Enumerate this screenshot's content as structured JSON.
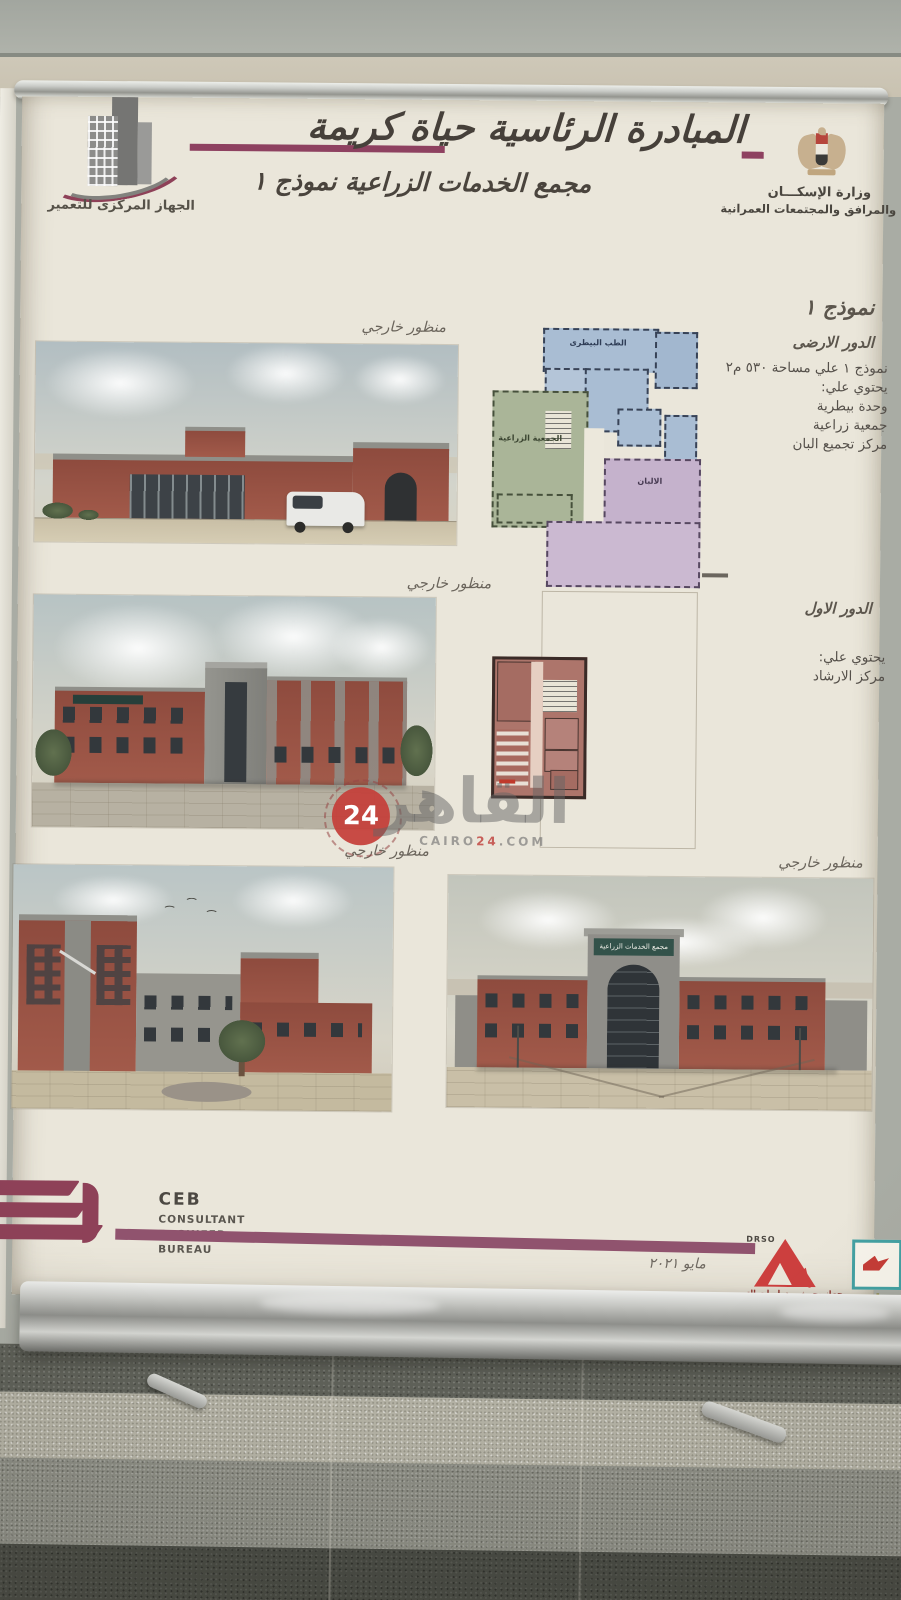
{
  "banner": {
    "header": {
      "agency_name": "الجهاز المركزى للتعمير",
      "title": "المبادرة الرئاسية حياة كريمة",
      "subtitle": "مجمع الخدمات الزراعية نموذج ١",
      "ministry_line1": "وزارة الإسكـــان",
      "ministry_line2": "والمرافق والمجتمعات العمرانية"
    },
    "model": {
      "heading": "نموذج ١",
      "ground": {
        "title": "الدور الارضى",
        "lines": [
          "نموذج ١ علي مساحة ٥٣٠ م٢",
          "يحتوي علي:",
          "وحدة بيطرية",
          "جمعية زراعية",
          "مركز تجميع البان"
        ]
      },
      "first": {
        "title": "الدور الاول",
        "lines": [
          "يحتوي علي:",
          "مركز الارشاد"
        ]
      }
    },
    "plan_labels": {
      "veterinary": "الطب البيطرى",
      "association": "الجمعية الزراعية",
      "dairy": "الالبان"
    },
    "perspective_label": "منظور خارجي",
    "building_sign": "مجمع الخدمات الزراعية",
    "watermark": {
      "badge": "24",
      "word": "القاهر",
      "domain_left": "CAIRO",
      "domain_mid": "24",
      "domain_right": ".COM"
    },
    "footer": {
      "ceb": {
        "abbr": "CEB",
        "line1": "CONSULTANT",
        "line2": "ENGINEER",
        "line3": "BUREAU"
      },
      "date": "مايو ٢٠٢١",
      "drso": {
        "abbr": "DRSO",
        "arabic": "جهاز بحوث و دراسات التعمير",
        "english1": "Developmental Research & Studies",
        "english2": "Organization"
      },
      "hayah": {
        "line1": "حياة",
        "line2": "كريمة"
      }
    },
    "colors": {
      "accent_maroon": "#8e4160",
      "banner_paper": "#eae6da",
      "brick_red": "#9c5446",
      "plan_blue": "#a9bdd3",
      "plan_green": "#aab598",
      "plan_purple": "#c5b2cc",
      "plan_red": "#ad756b",
      "watermark_red": "#c43c38",
      "drso_red": "#cc3f3e",
      "hayah_teal": "#43a0a2"
    }
  }
}
